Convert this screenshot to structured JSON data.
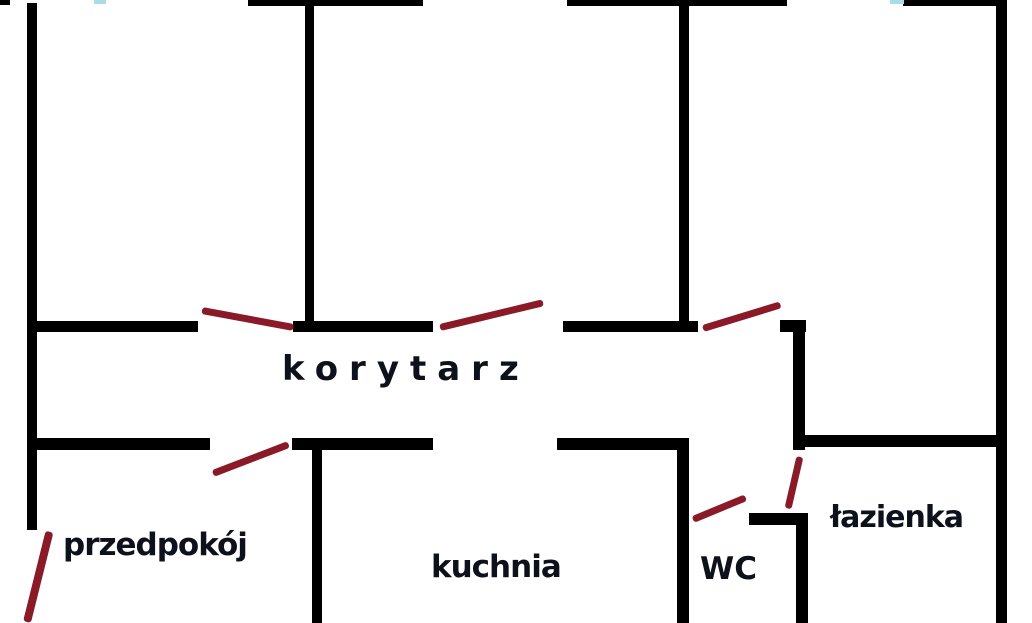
{
  "plan_title": "apartment floor plan sketch",
  "colors": {
    "background": "#ffffff",
    "wall": "#000000",
    "door_swing": "#8a1a28",
    "window_tick": "#aadce8",
    "label": "#0c111b"
  },
  "rooms": {
    "korytarz": "korytarz",
    "przedpokoj": "przedpokój",
    "kuchnia": "kuchnia",
    "wc": "WC",
    "lazienka": "łazienka"
  }
}
